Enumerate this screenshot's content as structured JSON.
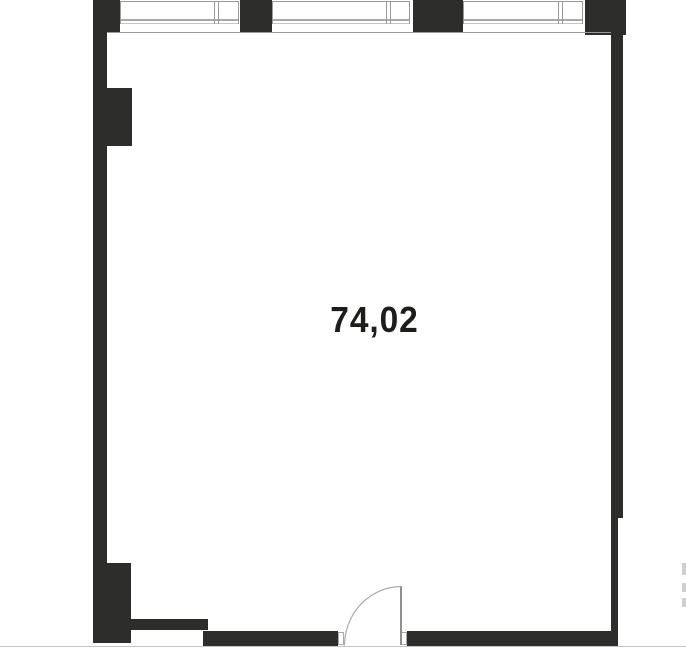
{
  "plan": {
    "area_label": "74,02"
  },
  "colors": {
    "wall": "#2d2d2b",
    "window_line": "#999999",
    "window_frame": "#a8a8a8",
    "window_line_light": "#c6c6c6",
    "door_line": "#aaaaaa",
    "door_panel": "#8f8f8f",
    "boundary_line": "#c3c3c3",
    "neighbor_fragment": "#cfcfcf",
    "area_text": "#1d1d1b",
    "background": "#ffffff"
  }
}
